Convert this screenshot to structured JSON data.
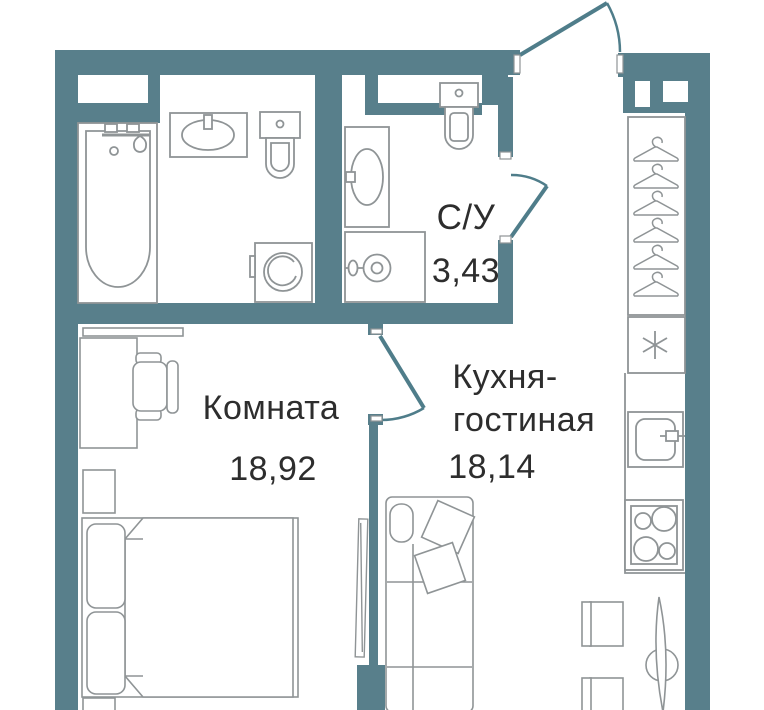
{
  "floorplan": {
    "type": "apartment-floor-plan",
    "wall_color": "#587f8b",
    "fixture_line_color": "#8f9496",
    "door_color": "#4f7d8a",
    "text_color": "#2d2d2d",
    "background": "#ffffff",
    "rooms": [
      {
        "name": "wc",
        "label": "С/У",
        "area": "3,43"
      },
      {
        "name": "bedroom",
        "label": "Комната",
        "area": "18,92"
      },
      {
        "name": "kitchen-living",
        "label_line1": "Кухня-",
        "label_line2": "гостиная",
        "area": "18,14"
      }
    ],
    "icons": [
      "bathtub-icon",
      "bath-sink-icon",
      "bath-toilet-icon",
      "washing-machine-icon",
      "wc-sink-icon",
      "wc-toilet-icon",
      "water-heater-icon",
      "wardrobe-icon",
      "hanger-icon",
      "asterisk-box-icon",
      "kitchen-sink-icon",
      "stove-icon",
      "dining-table-icon",
      "dining-chair-icon",
      "shelf-icon",
      "desk-icon",
      "office-chair-icon",
      "nightstand-icon",
      "bed-icon",
      "tv-icon",
      "sofa-icon",
      "door-swing-icon"
    ]
  }
}
